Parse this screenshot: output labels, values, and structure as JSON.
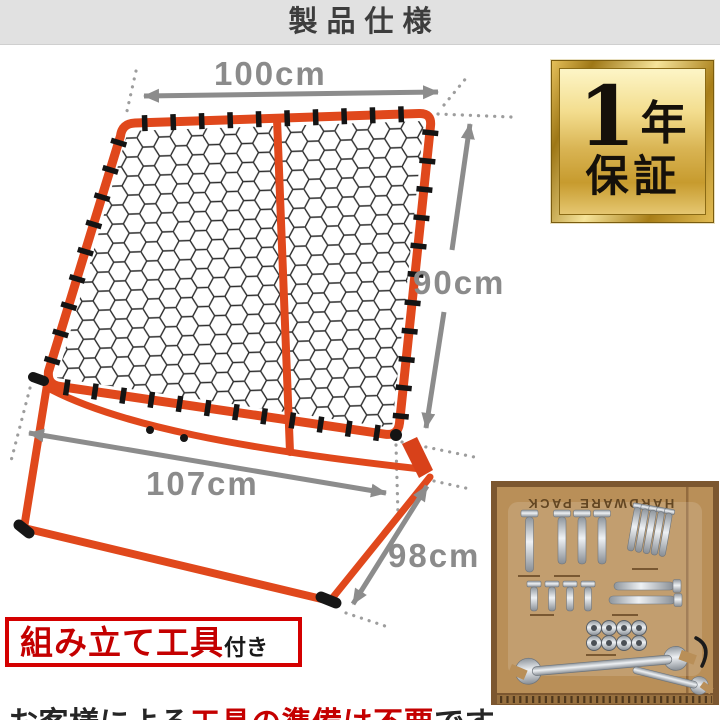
{
  "header": {
    "title": "製品仕様"
  },
  "product_diagram": {
    "dimensions": {
      "top_width": "100cm",
      "height": "90cm",
      "bottom_width": "107cm",
      "depth": "98cm"
    },
    "frame_color": "#e0481c",
    "net_color": "#2d2d2d",
    "dimension_color": "#8b8b8b"
  },
  "warranty_badge": {
    "number": "1",
    "unit": "年",
    "label": "保証"
  },
  "hardware_pack": {
    "label": "HARDWARE PACK"
  },
  "tools_note": {
    "box_text": "組み立て工具",
    "box_suffix": "付き",
    "sentence_prefix": "お客様による",
    "sentence_highlight": "工具の準備は不要",
    "sentence_suffix": "です。",
    "accent_red": "#c40000"
  }
}
